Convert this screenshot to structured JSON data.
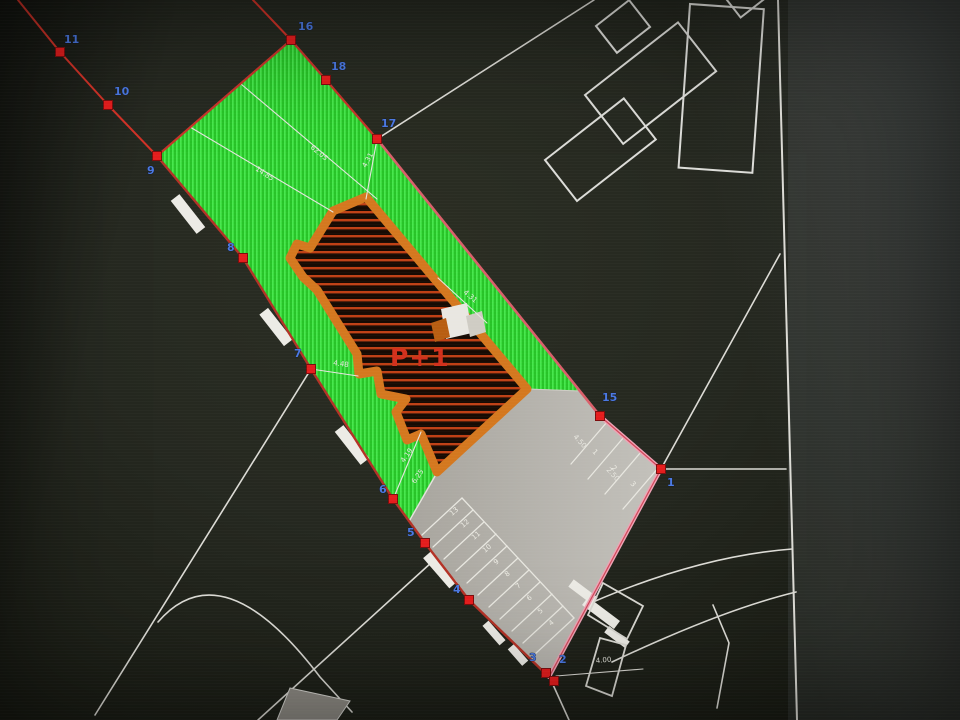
{
  "plan": {
    "building_label": "P+1",
    "points": {
      "p1": "1",
      "p2": "2",
      "p3": "3",
      "p4": "4",
      "p5": "5",
      "p6": "6",
      "p7": "7",
      "p8": "8",
      "p9": "9",
      "p10": "10",
      "p11": "11",
      "p15": "15",
      "p16": "16",
      "p17": "17",
      "p18": "18"
    },
    "dimensions": {
      "d1": "62.05",
      "d2": "14.85",
      "d3": "4.31",
      "d4": "4.31",
      "d5": "4.48",
      "d6": "4.19",
      "d7": "6.25",
      "d8": "4.00",
      "d9": "4.50",
      "d10": "2.50"
    },
    "parking": {
      "stall_numbers": [
        "1",
        "2",
        "3",
        "4",
        "5",
        "6",
        "7",
        "8",
        "9",
        "10",
        "11",
        "12",
        "13"
      ]
    },
    "colors": {
      "green_area": "#2fd32f",
      "building_outline_orange": "#d4781f",
      "building_hatch_red": "#bf4015",
      "boundary_red": "#c8342a",
      "boundary_pink": "#efa3b5",
      "point_label_blue": "#4b79e2",
      "parking_gray": "#b6b3ac",
      "line_white": "#e6e5df",
      "building_label_red": "#d2301c"
    }
  }
}
